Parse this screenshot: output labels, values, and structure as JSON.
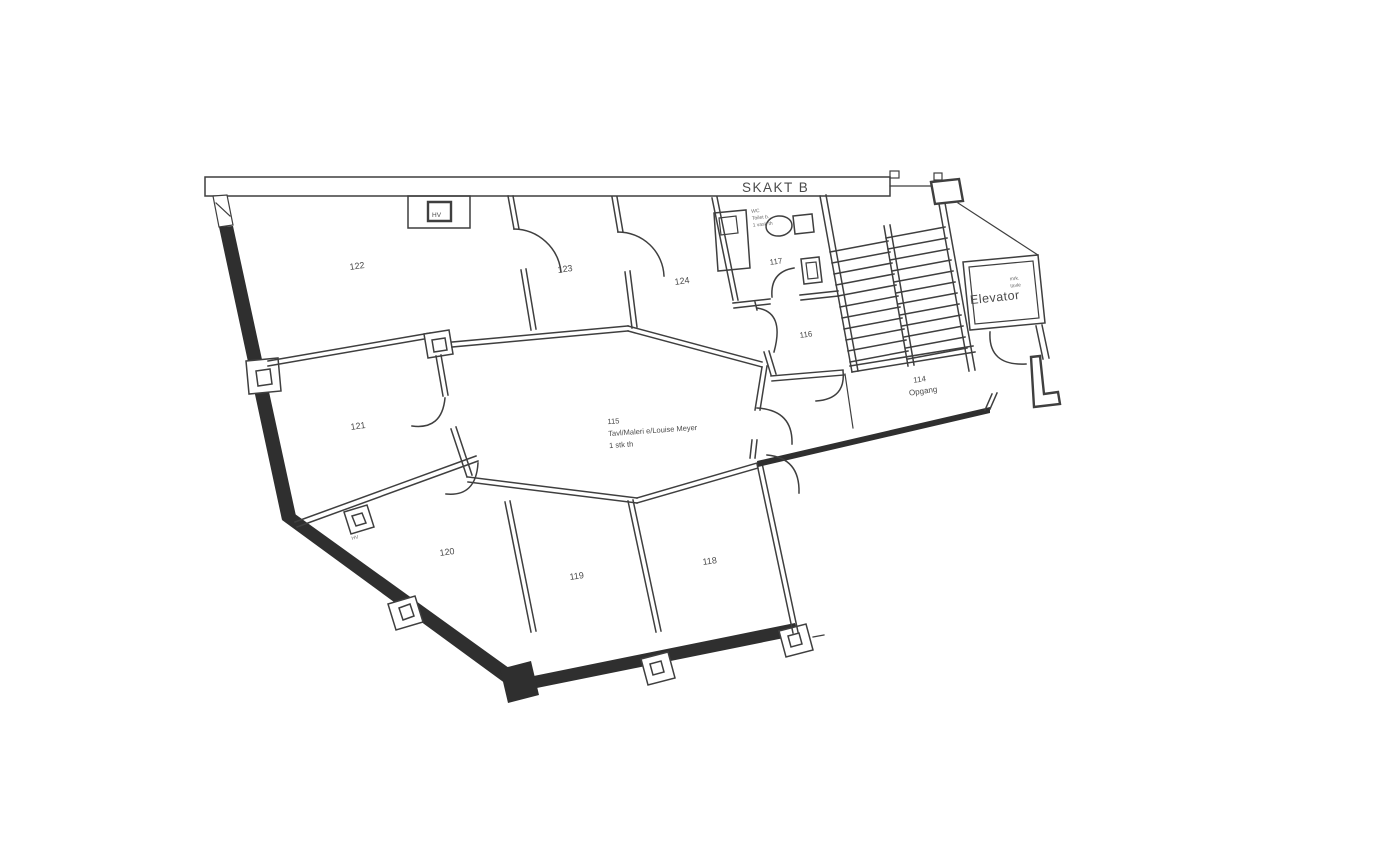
{
  "meta": {
    "document_type": "scanned architectural floor plan",
    "orientation_note": "building drawn tilted, shaft band horizontal"
  },
  "colors": {
    "ink": "#3f3f3f",
    "wall_fill": "#2f2f2f",
    "text": "#4a4a4a",
    "paper": "#ffffff"
  },
  "labels": {
    "skakt": "SKAKT B",
    "elevator": "Elevator",
    "elevator_note_1": "mrk.",
    "elevator_note_2": "tavle",
    "stair_number": "114",
    "stair_name": "Opgang",
    "room_115_no": "115",
    "room_115_l2": "Tavl/Maleri e/Louise Meyer",
    "room_115_l3": "1 stk th",
    "wc_note_1": "WC",
    "wc_note_2": "Toilet b.",
    "wc_note_3": "1 vask th",
    "hv_main": "HV",
    "hv_sub": "HV",
    "r122": "122",
    "r123": "123",
    "r124": "124",
    "r121": "121",
    "r120": "120",
    "r119": "119",
    "r118": "118",
    "r117": "117",
    "r116": "116"
  }
}
